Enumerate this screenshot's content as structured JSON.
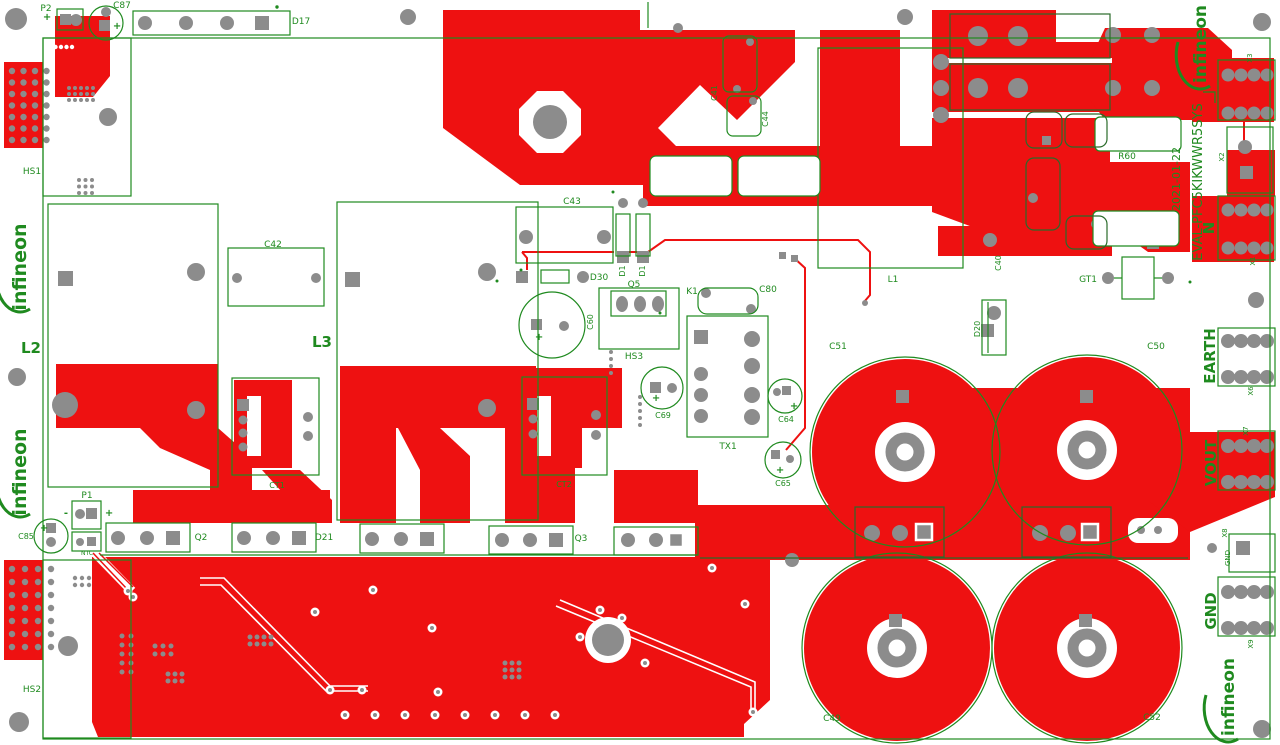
{
  "board": {
    "name": "EVAL-PFC5KIKWWR5SYS",
    "revision_date": "2021-01-22",
    "brand": "infineon"
  },
  "colors": {
    "copper": "#ee1111",
    "silkscreen": "#1f8a1f",
    "silkscreen_dark": "#2a6b2a",
    "pad": "#8c8c8c",
    "background": "#ffffff"
  },
  "labels": [
    {
      "t": "P2",
      "x": 46,
      "y": 11
    },
    {
      "t": "C87",
      "x": 122,
      "y": 8
    },
    {
      "t": "D17",
      "x": 301,
      "y": 24
    },
    {
      "t": "HS1",
      "x": 32,
      "y": 174
    },
    {
      "t": "L2",
      "x": 31,
      "y": 353,
      "size": 15,
      "bold": true
    },
    {
      "t": "C42",
      "x": 273,
      "y": 247
    },
    {
      "t": "L3",
      "x": 322,
      "y": 347,
      "size": 15,
      "bold": true
    },
    {
      "t": "C43",
      "x": 572,
      "y": 204
    },
    {
      "t": "D1",
      "x": 625,
      "y": 271,
      "rot": -90,
      "size": 8
    },
    {
      "t": "D1",
      "x": 645,
      "y": 271,
      "rot": -90,
      "size": 8
    },
    {
      "t": "D30",
      "x": 599,
      "y": 280
    },
    {
      "t": "Q5",
      "x": 634,
      "y": 287
    },
    {
      "t": "HS3",
      "x": 634,
      "y": 359
    },
    {
      "t": "C60",
      "x": 593,
      "y": 322,
      "rot": -90,
      "size": 8
    },
    {
      "t": "C69",
      "x": 663,
      "y": 418,
      "size": 8
    },
    {
      "t": "TX1",
      "x": 728,
      "y": 449
    },
    {
      "t": "K1",
      "x": 692,
      "y": 294
    },
    {
      "t": "C80",
      "x": 768,
      "y": 292
    },
    {
      "t": "C64",
      "x": 786,
      "y": 422,
      "size": 8
    },
    {
      "t": "C65",
      "x": 783,
      "y": 486,
      "size": 8
    },
    {
      "t": "C51",
      "x": 838,
      "y": 349
    },
    {
      "t": "C50",
      "x": 1156,
      "y": 349
    },
    {
      "t": "C49",
      "x": 832,
      "y": 721
    },
    {
      "t": "C52",
      "x": 1152,
      "y": 720
    },
    {
      "t": "L1",
      "x": 893,
      "y": 282
    },
    {
      "t": "C40",
      "x": 1001,
      "y": 263,
      "rot": -90,
      "size": 8
    },
    {
      "t": "GT1",
      "x": 1088,
      "y": 282
    },
    {
      "t": "D20",
      "x": 980,
      "y": 329,
      "rot": -90,
      "size": 8
    },
    {
      "t": "R60",
      "x": 1127,
      "y": 159
    },
    {
      "t": "C41",
      "x": 717,
      "y": 93,
      "rot": -90,
      "size": 8
    },
    {
      "t": "C44",
      "x": 768,
      "y": 119,
      "rot": -90,
      "size": 8
    },
    {
      "t": "X3",
      "x": 1252,
      "y": 58,
      "rot": -90,
      "size": 7
    },
    {
      "t": "X2",
      "x": 1224,
      "y": 157,
      "rot": -90,
      "size": 7
    },
    {
      "t": "X1",
      "x": 1255,
      "y": 261,
      "rot": -90,
      "size": 7
    },
    {
      "t": "N",
      "x": 1214,
      "y": 228,
      "rot": -90,
      "size": 15,
      "bold": true
    },
    {
      "t": "EVAL-PFC5KIKWWR5SYS",
      "x": 1202,
      "y": 182,
      "rot": -90,
      "size": 13
    },
    {
      "t": "2021-01-22",
      "x": 1180,
      "y": 179,
      "rot": -90,
      "size": 11
    },
    {
      "t": "EARTH",
      "x": 1215,
      "y": 356,
      "rot": -90,
      "size": 15,
      "bold": true
    },
    {
      "t": "X6",
      "x": 1253,
      "y": 391,
      "rot": -90,
      "size": 7
    },
    {
      "t": "VOUT",
      "x": 1216,
      "y": 463,
      "rot": -90,
      "size": 15,
      "bold": true
    },
    {
      "t": "X7",
      "x": 1248,
      "y": 431,
      "rot": -90,
      "size": 7
    },
    {
      "t": "X8",
      "x": 1227,
      "y": 533,
      "rot": -90,
      "size": 7
    },
    {
      "t": "GND",
      "x": 1230,
      "y": 558,
      "rot": -90,
      "size": 7
    },
    {
      "t": "GND",
      "x": 1216,
      "y": 611,
      "rot": -90,
      "size": 15,
      "bold": true
    },
    {
      "t": "X9",
      "x": 1253,
      "y": 644,
      "rot": -90,
      "size": 7
    },
    {
      "t": "P1",
      "x": 87,
      "y": 498
    },
    {
      "t": "C85",
      "x": 26,
      "y": 539,
      "size": 8
    },
    {
      "t": "NTC",
      "x": 87,
      "y": 555,
      "size": 6
    },
    {
      "t": "Q2",
      "x": 201,
      "y": 540
    },
    {
      "t": "D21",
      "x": 324,
      "y": 540
    },
    {
      "t": "Q3",
      "x": 581,
      "y": 541
    },
    {
      "t": "HS2",
      "x": 32,
      "y": 692
    },
    {
      "t": "CT1",
      "x": 277,
      "y": 488,
      "size": 8
    },
    {
      "t": "CT2",
      "x": 564,
      "y": 487,
      "size": 8
    }
  ],
  "marks": [
    {
      "t": "+",
      "x": 47,
      "y": 20
    },
    {
      "t": "+",
      "x": 117,
      "y": 29
    },
    {
      "t": "+",
      "x": 539,
      "y": 340
    },
    {
      "t": "+",
      "x": 656,
      "y": 401
    },
    {
      "t": "+",
      "x": 794,
      "y": 409
    },
    {
      "t": "+",
      "x": 780,
      "y": 473
    },
    {
      "t": "+",
      "x": 44,
      "y": 531
    },
    {
      "t": "-",
      "x": 66,
      "y": 516
    },
    {
      "t": "+",
      "x": 109,
      "y": 516
    }
  ],
  "logos": [
    {
      "x": 20,
      "y": 267,
      "rot": -90,
      "size": 19
    },
    {
      "x": 20,
      "y": 472,
      "rot": -90,
      "size": 19
    },
    {
      "x": 1200,
      "y": 44,
      "rot": -90,
      "size": 17
    },
    {
      "x": 1228,
      "y": 697,
      "rot": -90,
      "size": 17
    }
  ]
}
